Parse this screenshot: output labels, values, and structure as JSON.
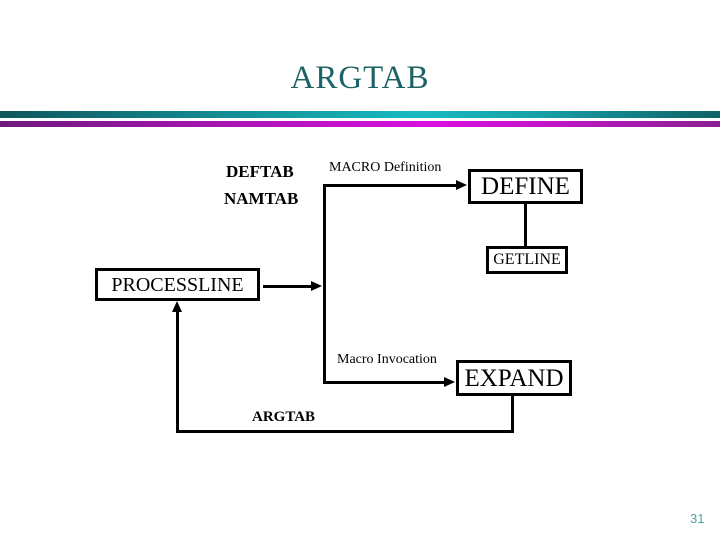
{
  "slide": {
    "title": "ARGTAB",
    "page_number": "31",
    "colors": {
      "title_text": "#1E6363",
      "teal_bar_dark": "#0E565C",
      "teal_bar_bright": "#18BAC1",
      "magenta_bar_dark": "#6E1A7C",
      "magenta_bar_bright": "#D90FE0",
      "page_number_text": "#50A1A9",
      "diagram_line": "#000000"
    }
  },
  "diagram": {
    "side_labels": {
      "deftab": "DEFTAB",
      "namtab": "NAMTAB"
    },
    "edge_labels": {
      "macro_definition": "MACRO Definition",
      "macro_invocation": "Macro Invocation",
      "argtab_feedback": "ARGTAB"
    },
    "boxes": {
      "define": "DEFINE",
      "getline": "GETLINE",
      "processline": "PROCESSLINE",
      "expand": "EXPAND"
    }
  }
}
